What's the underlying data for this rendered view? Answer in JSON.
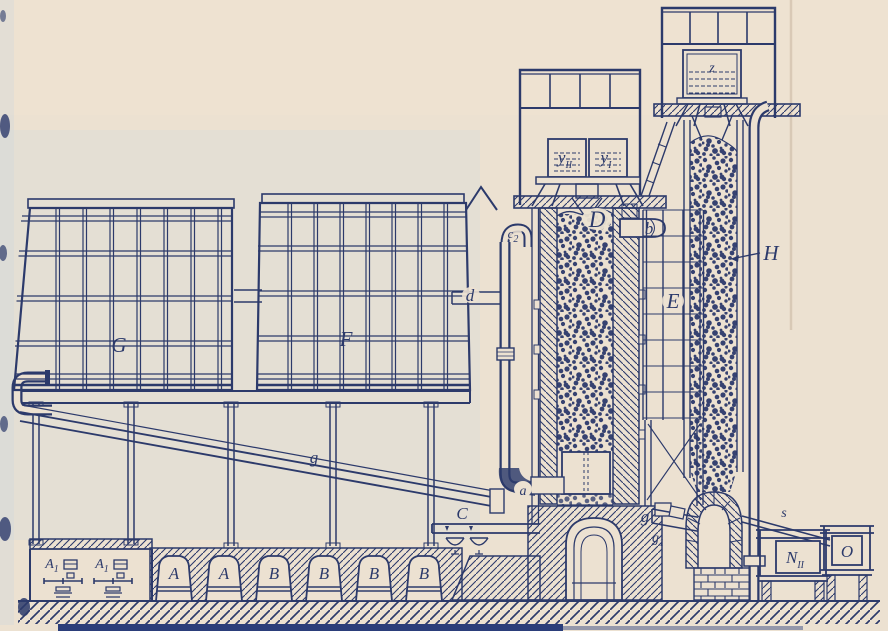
{
  "figure": {
    "type": "engineering-elevation-diagram",
    "colors": {
      "ink": "#2c3a6b",
      "paper": "#ece1d1",
      "paper_tint": "#cfdcda",
      "bottom_strip": "#2b3e7a"
    }
  },
  "labels": {
    "z": "z",
    "y_left": {
      "base": "y",
      "sub": "II"
    },
    "y_right": {
      "base": "y",
      "sub": "I"
    },
    "shaft_d": "D",
    "pipe_b": "b",
    "c2": {
      "base": "c",
      "sub": "2"
    },
    "pipe_d": "d",
    "tank_g": "G",
    "tank_f": "F",
    "tower_e": "E",
    "column_h": "H",
    "conveyor_g": "g",
    "elbow_a": "a",
    "scales_c": "C",
    "chute_g": "g",
    "chute_g1": {
      "base": "g",
      "sub": "1"
    },
    "chute_s": "s",
    "machine_a1_left": {
      "base": "A",
      "sub": "1"
    },
    "machine_a1_right": {
      "base": "A",
      "sub": "1"
    },
    "hoppers": [
      "A",
      "A",
      "B",
      "B",
      "B",
      "B"
    ],
    "box_n": {
      "base": "N",
      "sub": "II"
    },
    "box_o": "O"
  }
}
